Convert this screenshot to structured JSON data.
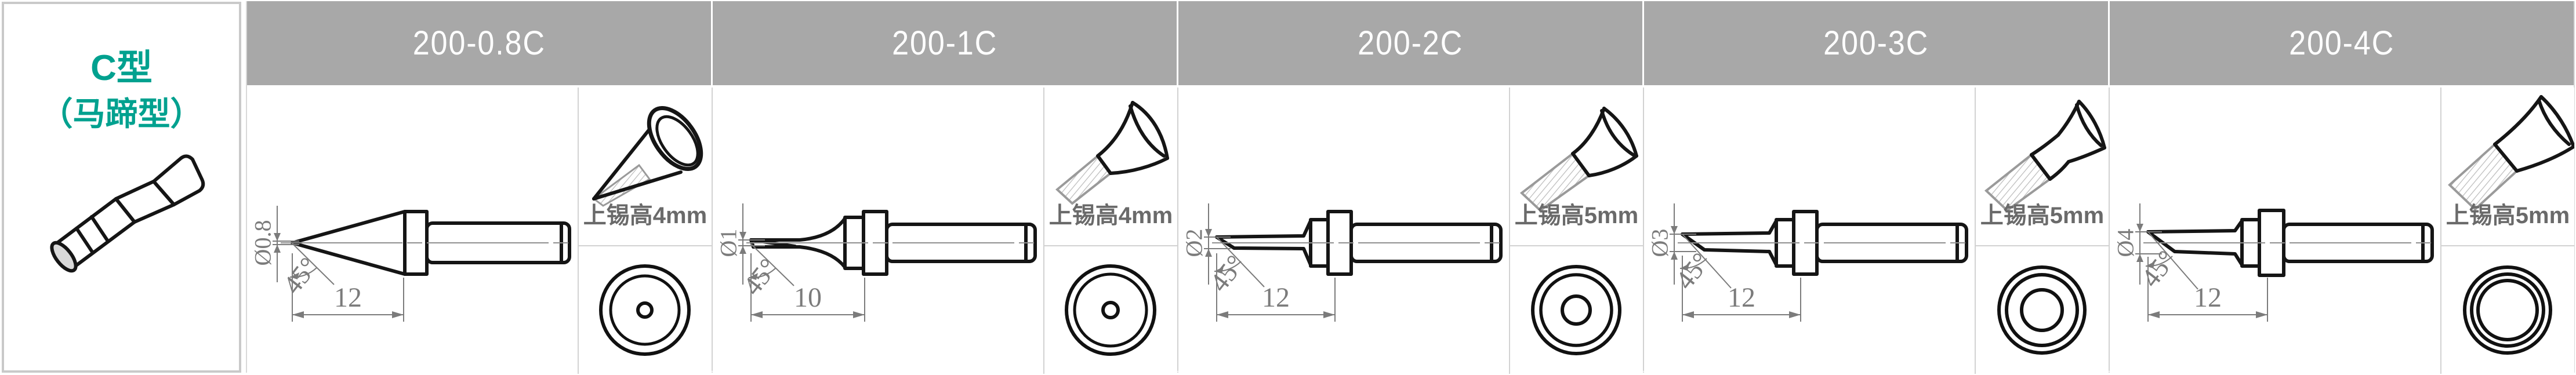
{
  "legend": {
    "title": "C型",
    "subtitle": "（马蹄型）"
  },
  "colors": {
    "accent_teal": "#00a18f",
    "header_bg": "#a8a8a8",
    "header_text": "#ffffff",
    "grid_line": "#d2d2d2",
    "dimension_gray": "#7b7b7b",
    "tin_text_gray": "#6a6a6a",
    "drawing_black": "#151515"
  },
  "columns": [
    {
      "model": "200-0.8C",
      "diameter_label": "Ø0.8",
      "angle_label": "45°",
      "length_label": "12",
      "tin_height_label": "上锡高4mm"
    },
    {
      "model": "200-1C",
      "diameter_label": "Ø1",
      "angle_label": "45°",
      "length_label": "10",
      "tin_height_label": "上锡高4mm"
    },
    {
      "model": "200-2C",
      "diameter_label": "Ø2",
      "angle_label": "45°",
      "length_label": "12",
      "tin_height_label": "上锡高5mm"
    },
    {
      "model": "200-3C",
      "diameter_label": "Ø3",
      "angle_label": "45°",
      "length_label": "12",
      "tin_height_label": "上锡高5mm"
    },
    {
      "model": "200-4C",
      "diameter_label": "Ø4",
      "angle_label": "45°",
      "length_label": "12",
      "tin_height_label": "上锡高5mm"
    }
  ]
}
